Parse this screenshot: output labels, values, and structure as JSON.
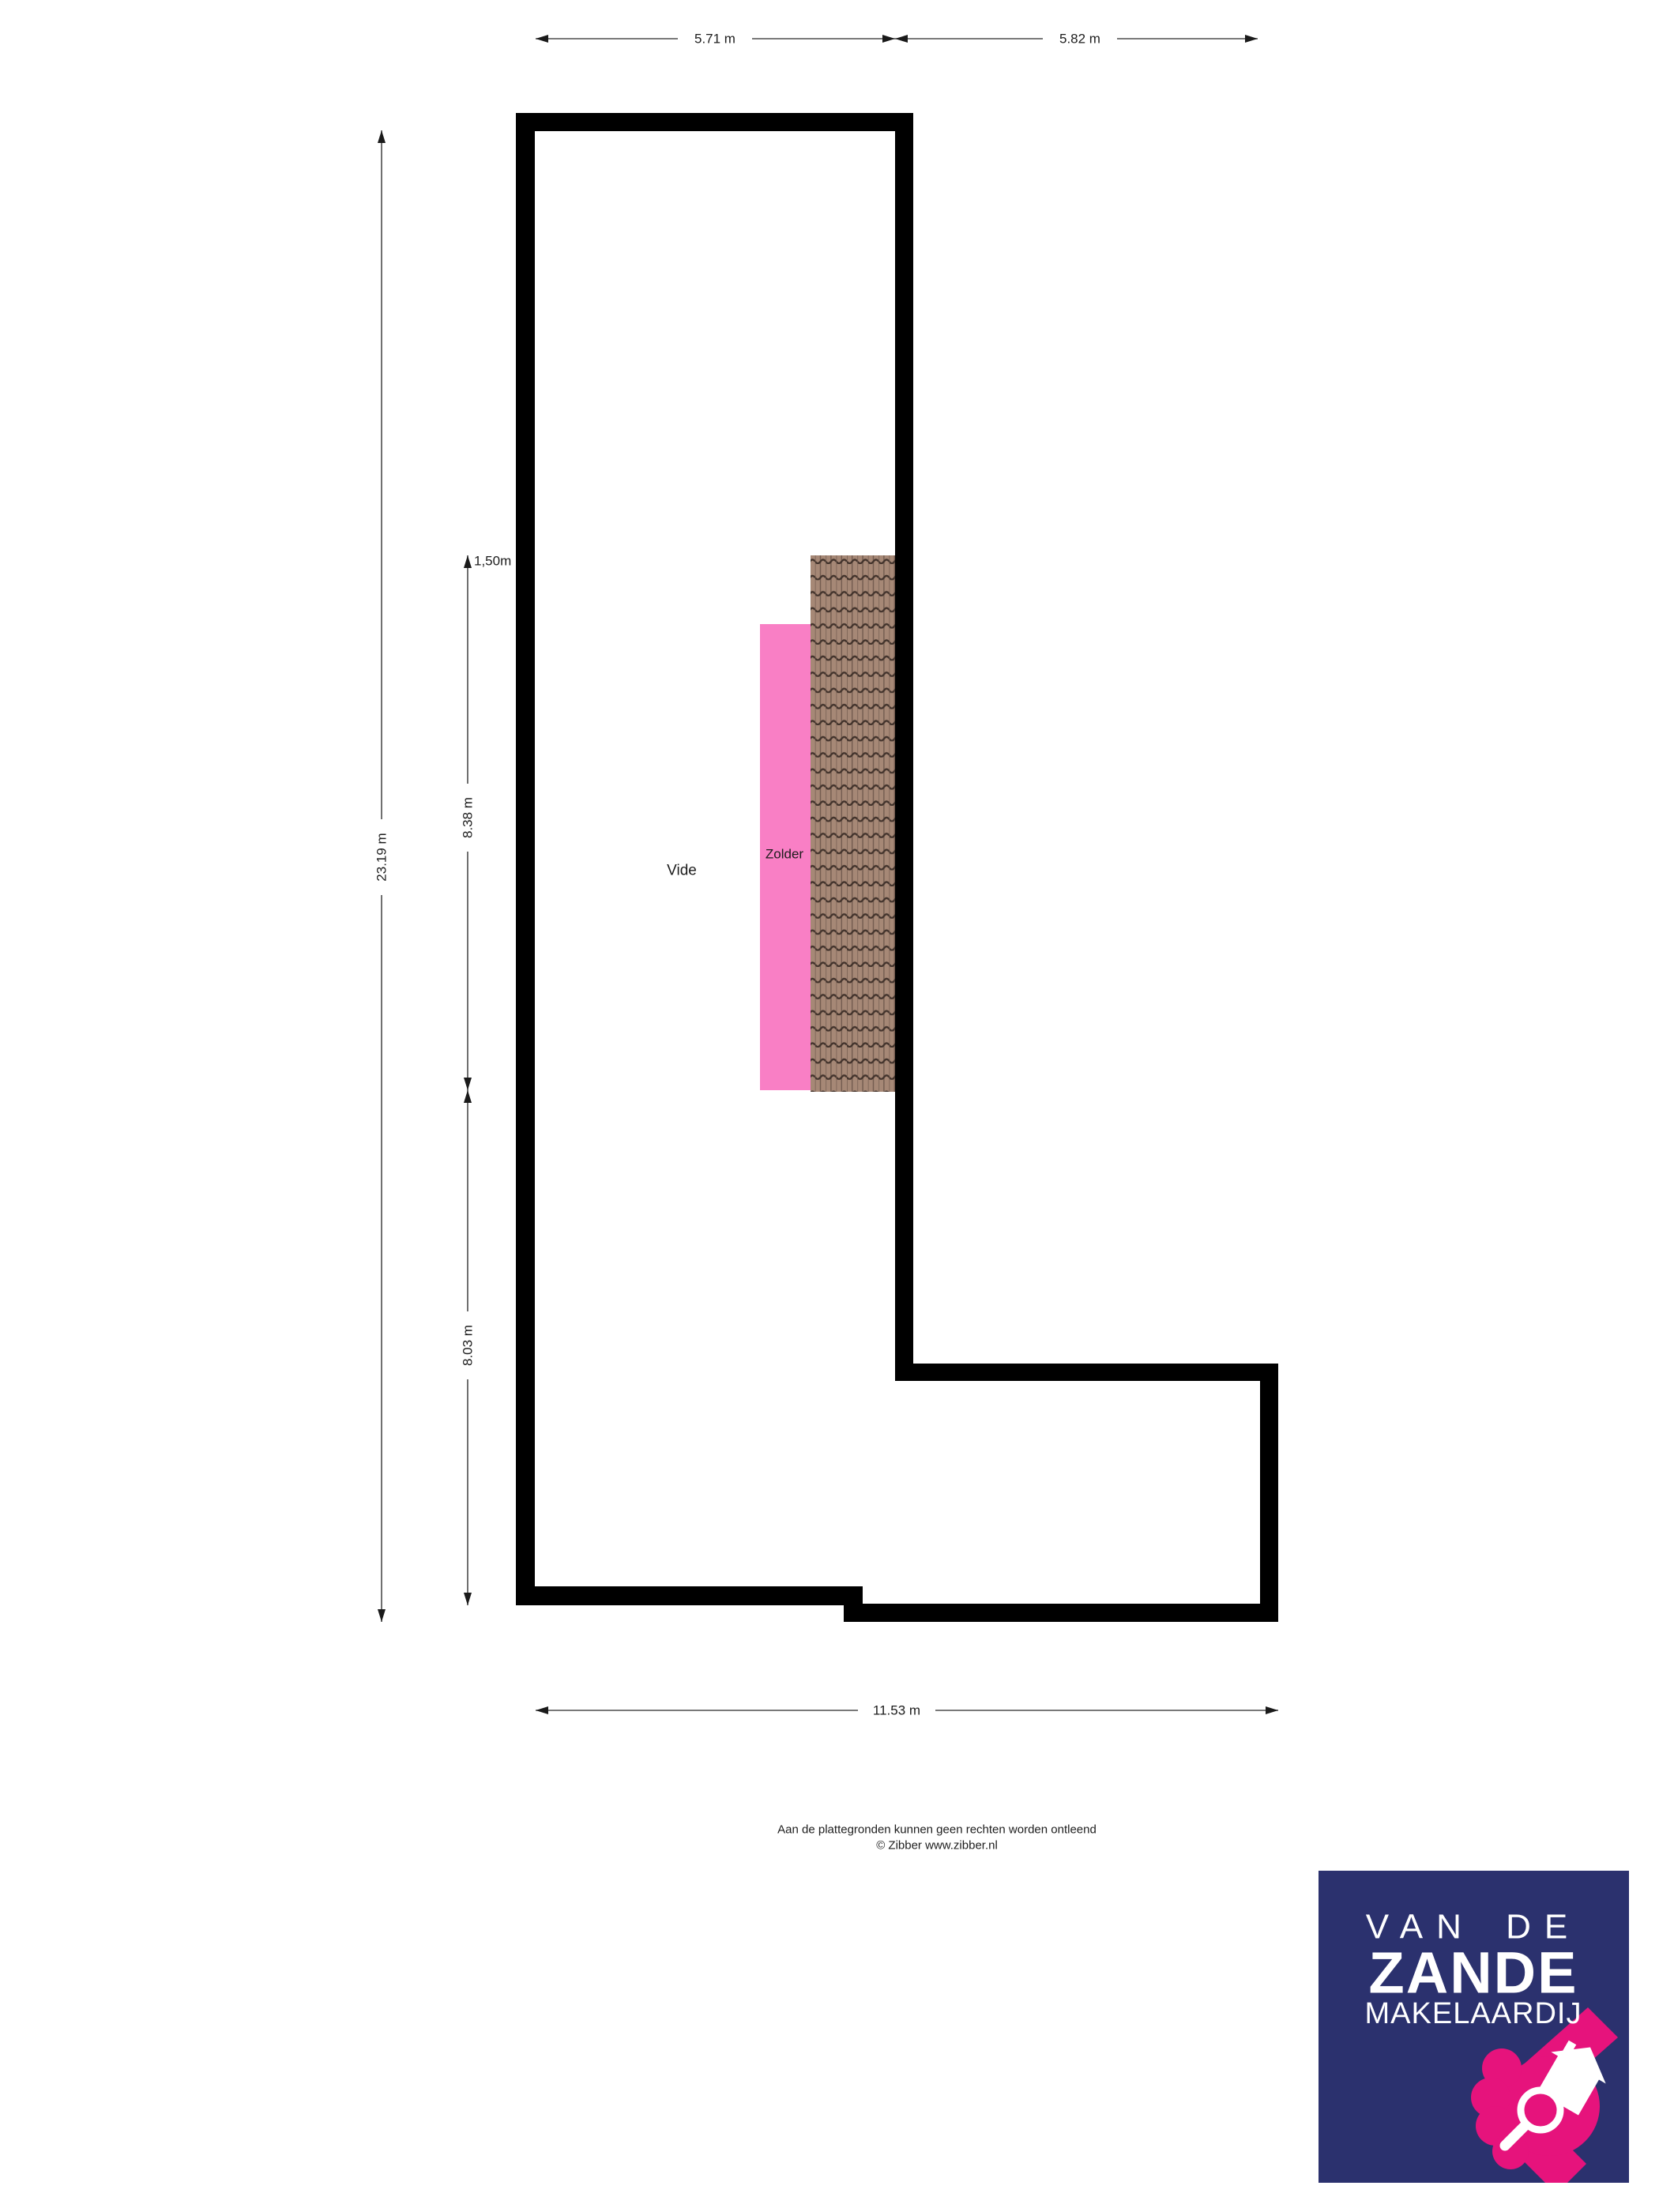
{
  "floorplan": {
    "dimensions": {
      "top_left": "5.71 m",
      "top_right": "5.82 m",
      "left": "23.19 m",
      "headroom": "1,50m",
      "inner_upper": "8.38 m",
      "inner_lower": "8.03 m",
      "bottom": "11.53 m"
    },
    "room_labels": [
      {
        "id": "vide",
        "label": "Vide"
      },
      {
        "id": "zolder",
        "label": "Zolder"
      }
    ],
    "colors": {
      "wall": "#000000",
      "zolder_fill": "#f97fc5",
      "tile_base": "#a68876",
      "tile_line": "#42332c",
      "tile_ridge": "#6e584c",
      "dim_line": "#4d4d4d",
      "arrow": "#1a1a1a",
      "text": "#1c1c1c"
    }
  },
  "footer": {
    "disclaimer": "Aan de plattegronden kunnen geen rechten worden ontleend",
    "copyright": "© Zibber www.zibber.nl"
  },
  "logo": {
    "line1": "VAN DE",
    "line2": "ZANDE",
    "line3": "MAKELAARDIJ",
    "navy": "#2b316e",
    "pink": "#e6137c"
  }
}
